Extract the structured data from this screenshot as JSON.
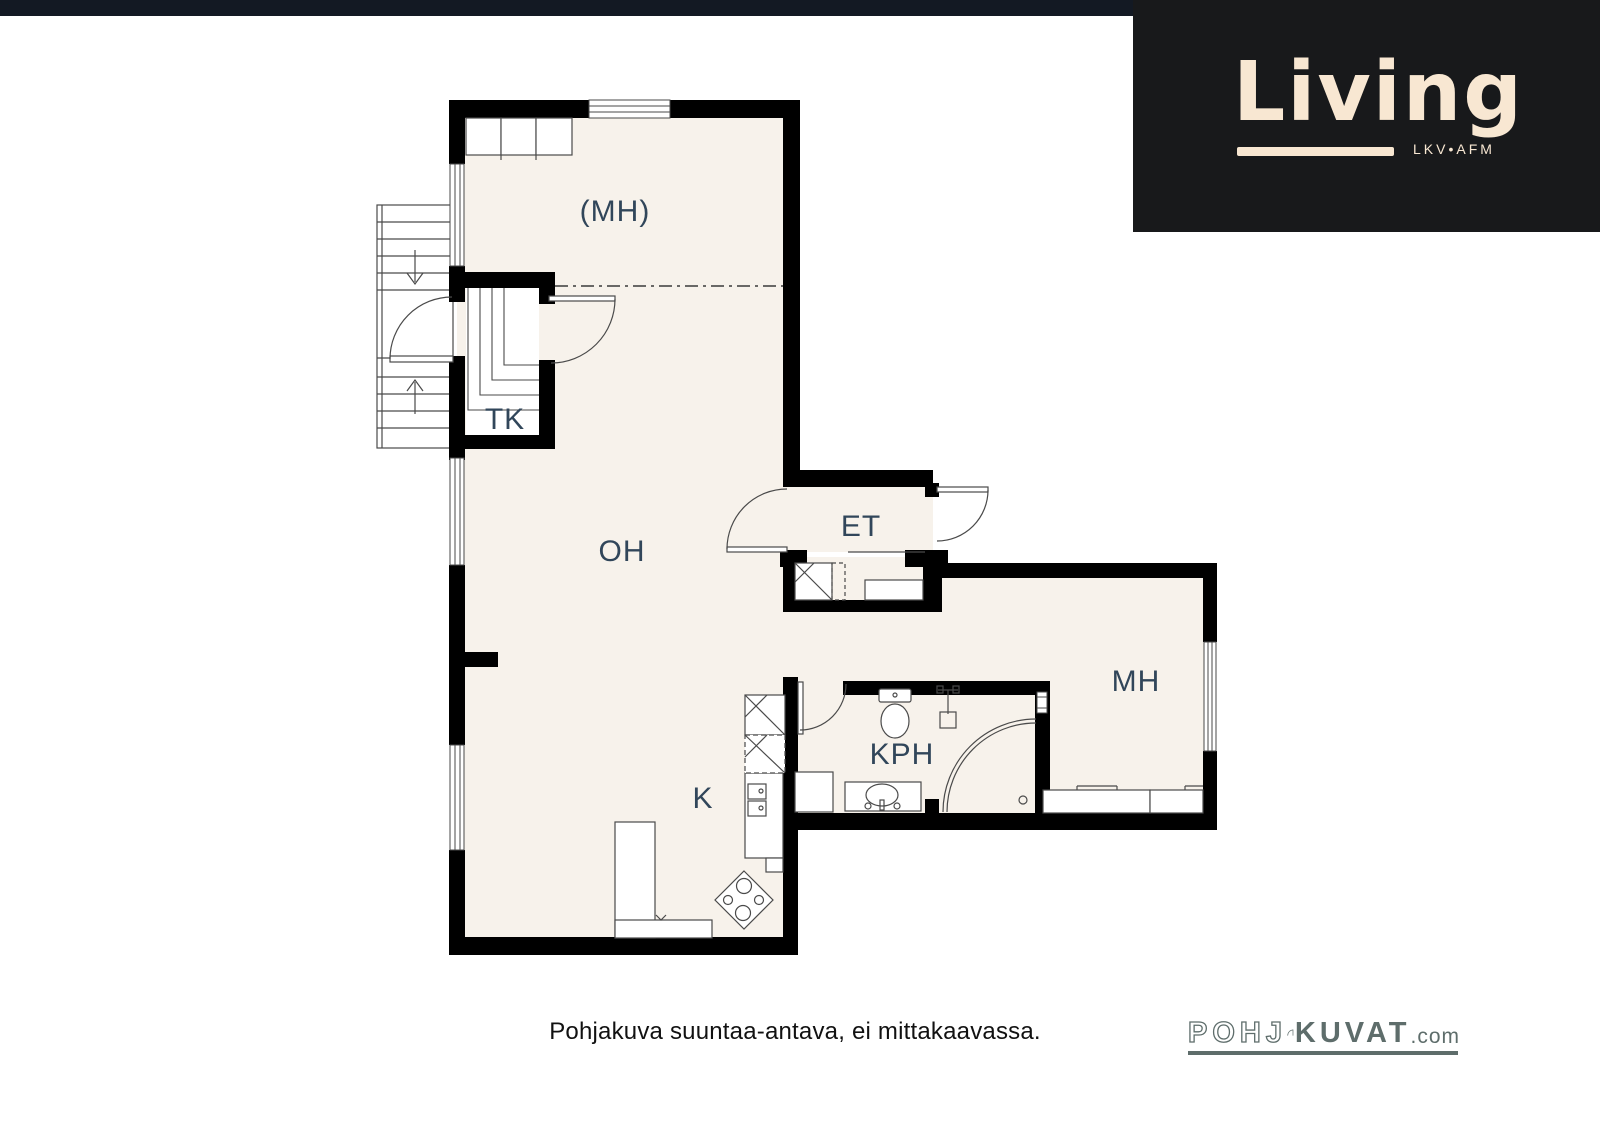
{
  "header": {
    "top_bar_color": "#131923",
    "living_logo": {
      "text": "Living",
      "tagline": "LKV•AFM",
      "text_color": "#f8e7d2",
      "background_color": "#18191b"
    }
  },
  "floorplan": {
    "wall_color": "#000000",
    "floor_color": "#f7f2eb",
    "label_color": "#31465a",
    "line_color": "#4a4a4a",
    "rooms": [
      {
        "id": "mh_upper",
        "label": "(MH)"
      },
      {
        "id": "tk",
        "label": "TK"
      },
      {
        "id": "oh",
        "label": "OH"
      },
      {
        "id": "et",
        "label": "ET"
      },
      {
        "id": "kph",
        "label": "KPH"
      },
      {
        "id": "mh",
        "label": "MH"
      },
      {
        "id": "k",
        "label": "K"
      }
    ]
  },
  "footer": {
    "caption": "Pohjakuva suuntaa-antava, ei mittakaavassa.",
    "pohjakuvat_logo": {
      "outline_text": "POHJ",
      "solid_text": "KUVAT",
      "suffix": ".com",
      "color": "#5e6d6b"
    }
  }
}
